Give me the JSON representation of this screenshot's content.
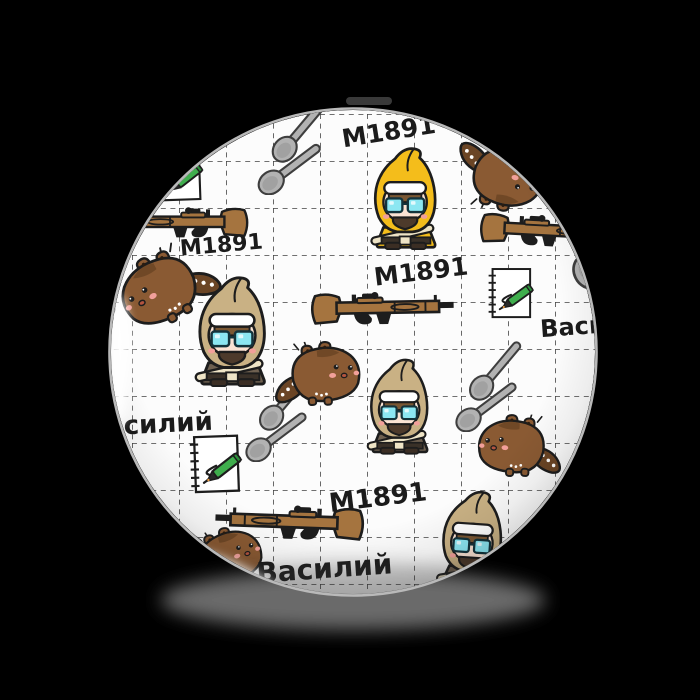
{
  "page": {
    "background": "#000000"
  },
  "badge": {
    "type": "round-pin-badge",
    "labels": {
      "rifle_model": "М1891",
      "sniper_name": "Василий"
    },
    "label_counts": {
      "rifle_model": 4,
      "sniper_name": 3
    },
    "motifs": [
      "sniper-character-yellow-hood",
      "sniper-character-tan-hood",
      "mosin-nagant-rifle",
      "brown-creature",
      "crossed-spoons",
      "sketchbook-with-green-pen",
      "dashed-grid-paper"
    ]
  },
  "colors": {
    "background": "#000000",
    "badge_face": "#fcfcfc",
    "grid": "#2d2d2d",
    "text": "#1b1b1b",
    "outline": "#1d1d1d",
    "rim": "#b9b9b9",
    "rifle_wood": "#a5743f",
    "rifle_metal": "#1d1d1d",
    "hood_yellow": "#f4bd1b",
    "hood_tan": "#c9b184",
    "robe_tan": "#6e6050",
    "creature_body": "#8a5a33",
    "creature_tail": "#6b4525",
    "spoon": "#b2b2b2",
    "pen_green": "#3fae4d",
    "goggle_cyan": "#8ce7f2",
    "skin": "#fbe3d3",
    "cheek": "#f2a09a",
    "band_white": "#ffffff",
    "hair_brown": "#7a5733",
    "sling_cream": "#eee4c6",
    "boots": "#3b2e24"
  }
}
